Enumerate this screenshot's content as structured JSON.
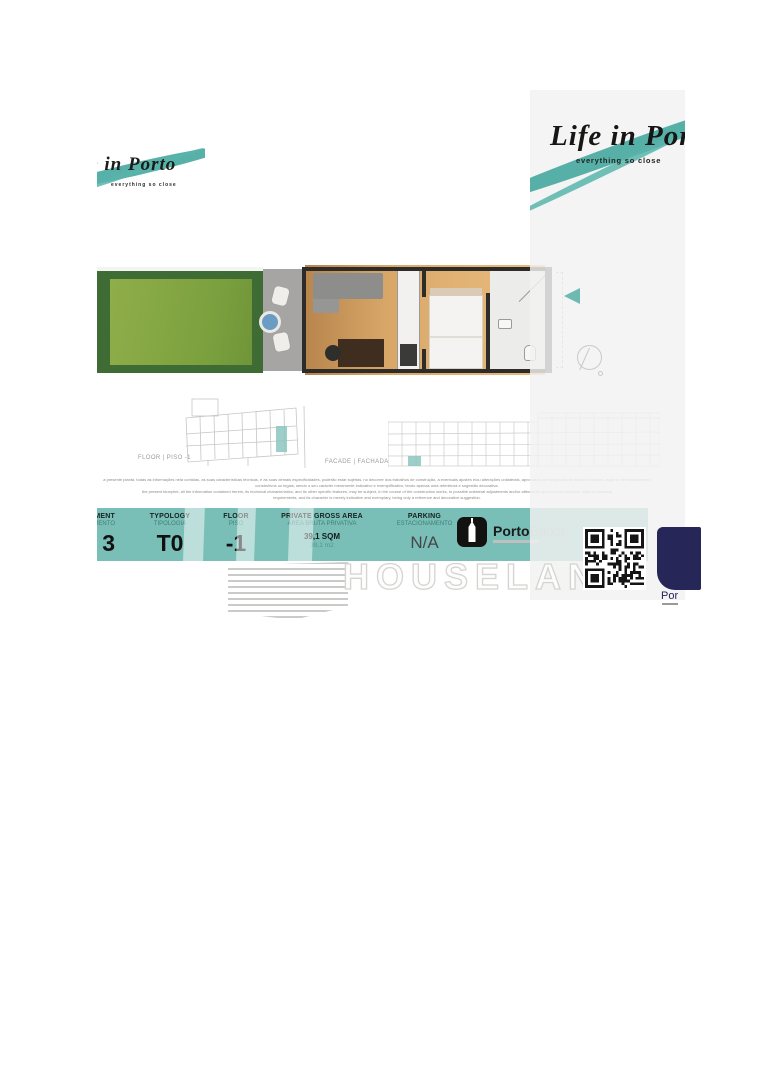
{
  "brand": {
    "logo_text": "Life in Porto",
    "tagline": "everything so close",
    "teal": "#46a9a0"
  },
  "drawings": {
    "floor_label": "FLOOR | PISO -1",
    "facade_label": "FACADE | FACHADA"
  },
  "disclaimer": {
    "lines": [
      "a presente planta, todas as informações nela contidas, as suas características técnicas, e as suas demais especificidades, poderão estar sujeitas, no decorrer dos trabalhos de construção, a eventuais ajustes e/ou alterações unilaterais, aprovadas por exigências de natureza técnica, legal ou de licenciamento",
      "construtivos ou legais, sendo o seu carácter meramente indicativo e exemplificativo, tendo apenas uma referência e sugestão decorativa.",
      "the present blueprint, all the information contained herein, its technical characteristics, and its other specific features, may be subject, in the course of the construction works, to possible unilateral adjustments and/or alterations approved by technical, legal or licensing",
      "requirements, and its character is merely indicative and exemplary, being only a reference and decorative suggestion."
    ]
  },
  "spec_table": {
    "columns": [
      {
        "label": "APARTMENT",
        "sublabel": "APARTAMENTO",
        "value": "3"
      },
      {
        "label": "TYPOLOGY",
        "sublabel": "TIPOLOGIA",
        "value": "T0"
      },
      {
        "label": "FLOOR",
        "sublabel": "PISO",
        "value": "-1"
      },
      {
        "label": "PRIVATE GROSS AREA",
        "sublabel": "ÁREA BRUTA PRIVATIVA",
        "value": "39,1 SQM",
        "value2": "39,1 m2"
      },
      {
        "label": "PARKING",
        "sublabel": "ESTACIONAMENTO",
        "value": "N/A"
      }
    ],
    "accent_color": "#79bfb8"
  },
  "partners": {
    "portobaixa": {
      "name_bold": "Porto",
      "name_light": "Baixa"
    },
    "corner_logo_text": "Por"
  },
  "watermark": {
    "text": "HOUSELAND"
  }
}
